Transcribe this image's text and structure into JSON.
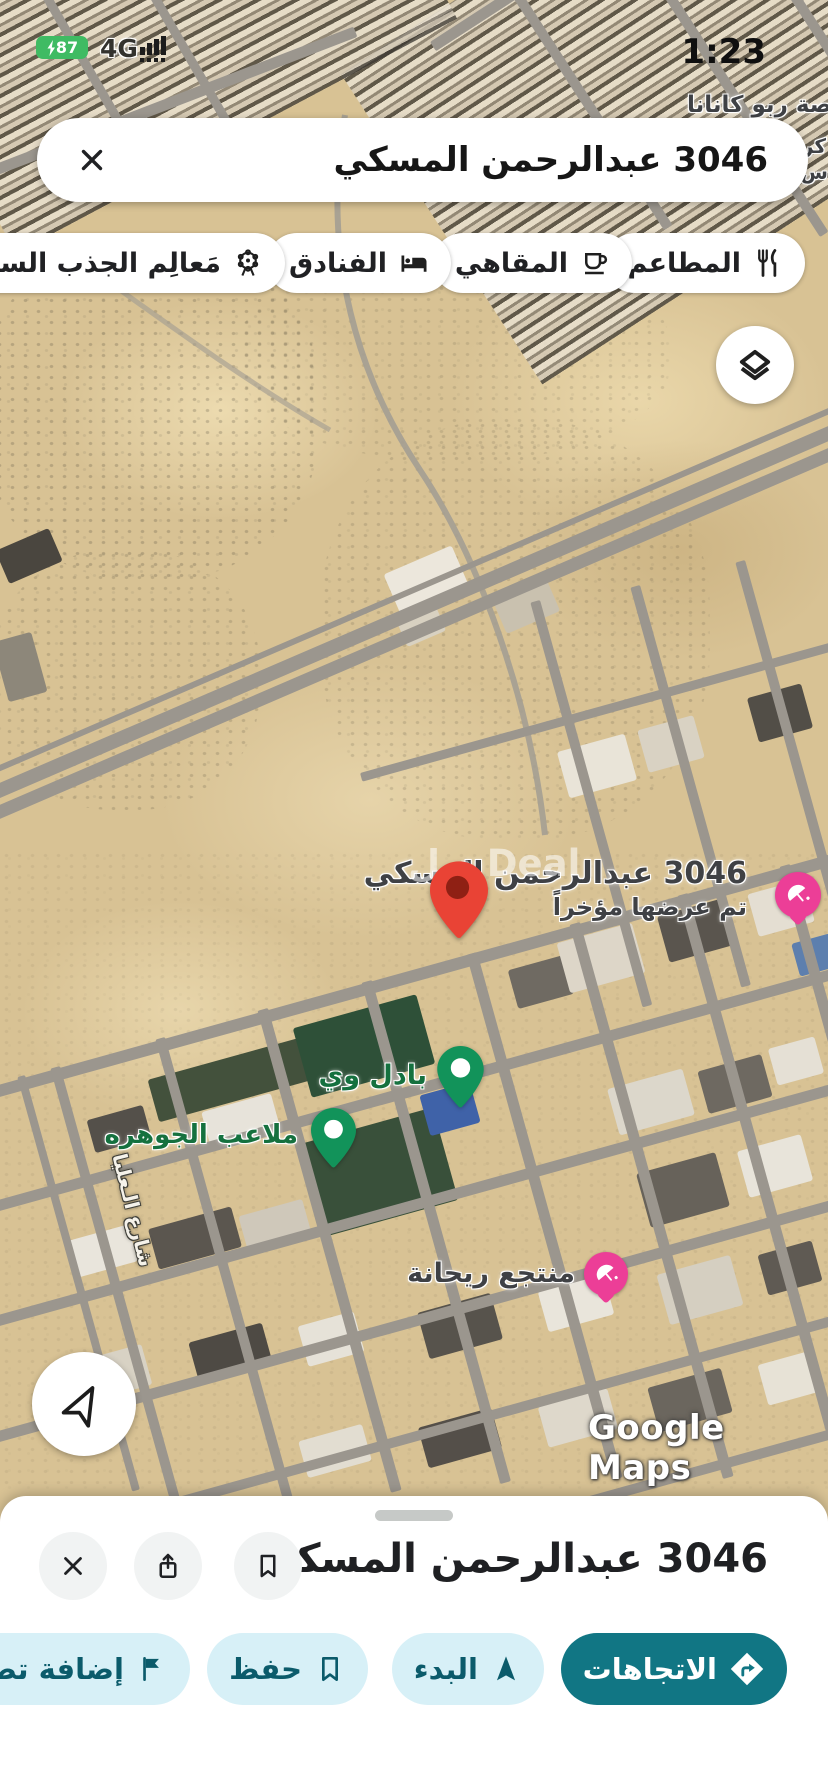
{
  "status": {
    "battery": "87",
    "network": "4G",
    "time": "1:23"
  },
  "search": {
    "query": "3046 عبدالرحمن المسكي"
  },
  "chips": [
    {
      "label": "المطاعم"
    },
    {
      "label": "المقاهي"
    },
    {
      "label": "الفنادق"
    },
    {
      "label": "مَعالِم الجذب السياحي"
    }
  ],
  "map": {
    "pin_title": "3046 عبدالرحمن المسكي",
    "pin_subtitle": "تم عرضها مؤخراً",
    "app_watermark": "ديل Deal",
    "poi": [
      {
        "name": "بادل وي"
      },
      {
        "name": "ملاعب الجوهره"
      },
      {
        "name": "منتجع ريحانة"
      }
    ],
    "street": "شارع الـعليا",
    "area": "صة ربو كانانا",
    "frag_a": "كر",
    "frag_b": "س تق",
    "frag_c": "شا",
    "google": "Google Maps"
  },
  "sheet": {
    "title": "3046 عبدالرحمن المسكي",
    "actions": [
      {
        "label": "الاتجاهات"
      },
      {
        "label": "البدء"
      },
      {
        "label": "حفظ"
      },
      {
        "label": "إضافة تصنيف"
      }
    ]
  },
  "colors": {
    "primary_teal": "#117684",
    "action_bg": "#d7f0f7",
    "pin_red": "#e94335",
    "poi_green": "#12935a",
    "poi_pink": "#ec3e97",
    "battery_green": "#3fbb63"
  }
}
